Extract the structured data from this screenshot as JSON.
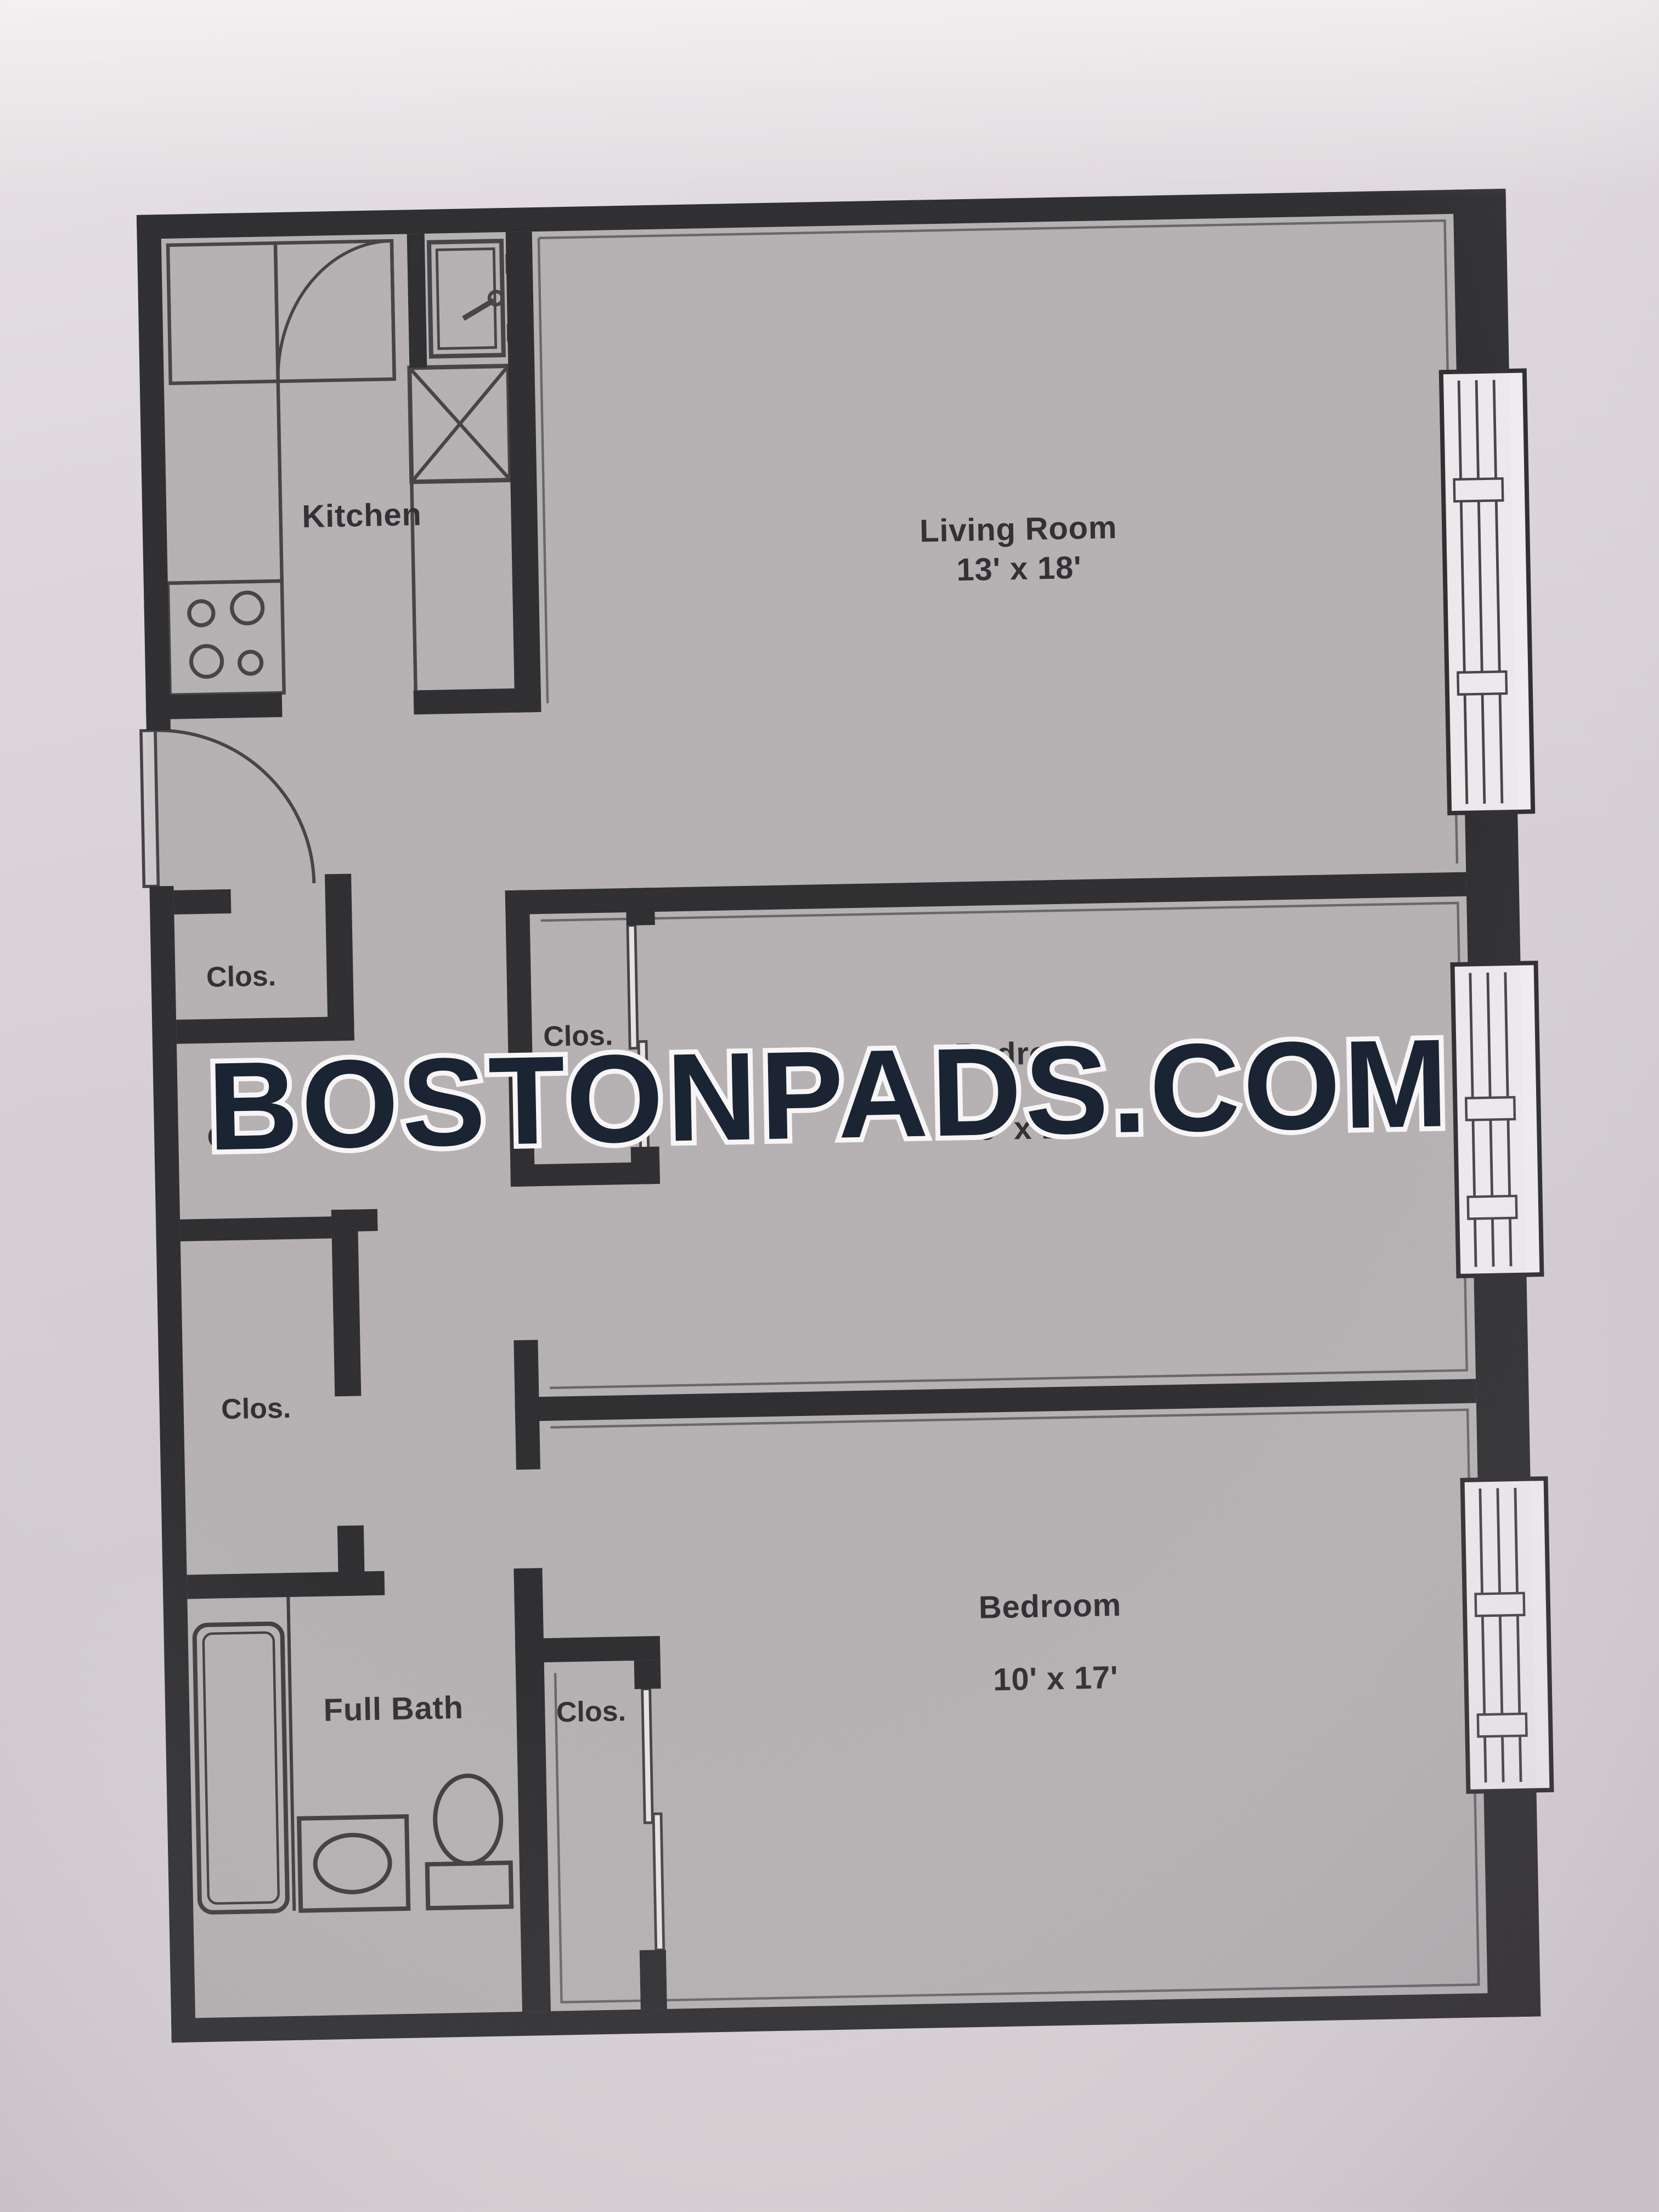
{
  "watermark": {
    "text": "BOSTONPADS.COM",
    "fill_color": "#1a2433",
    "outline_color": "#f7f5f6"
  },
  "rooms": {
    "kitchen": {
      "label": "Kitchen"
    },
    "living_room": {
      "label": "Living Room",
      "dims": "13' x 18'"
    },
    "bedroom_1": {
      "label": "Bedroom",
      "dims": "9' x 17'"
    },
    "bedroom_2": {
      "label": "Bedroom",
      "dims": "10' x 17'"
    },
    "bathroom": {
      "label": "Full Bath"
    }
  },
  "closets": {
    "hall_top": {
      "label": "Clos."
    },
    "hall_middle": {
      "label": "Clos."
    },
    "hall_lower": {
      "label": "Clos."
    },
    "bedroom_1": {
      "label": "Clos."
    },
    "bedroom_2": {
      "label": "Clos."
    }
  },
  "fixtures": {
    "kitchen": [
      "corner-cabinet",
      "cabinet-door-swing",
      "counter-run",
      "stove-4-burners",
      "sink",
      "appliance-x-box"
    ],
    "bathroom": [
      "bathtub",
      "vanity-sink",
      "toilet"
    ],
    "windows_on_right_wall": 3,
    "entry": "hinged-door-left-wall"
  },
  "palette": {
    "paper": "#d9d3d7",
    "plan_floor": "#b7b3b5",
    "walls": "#2e2d30",
    "text": "#333135"
  }
}
